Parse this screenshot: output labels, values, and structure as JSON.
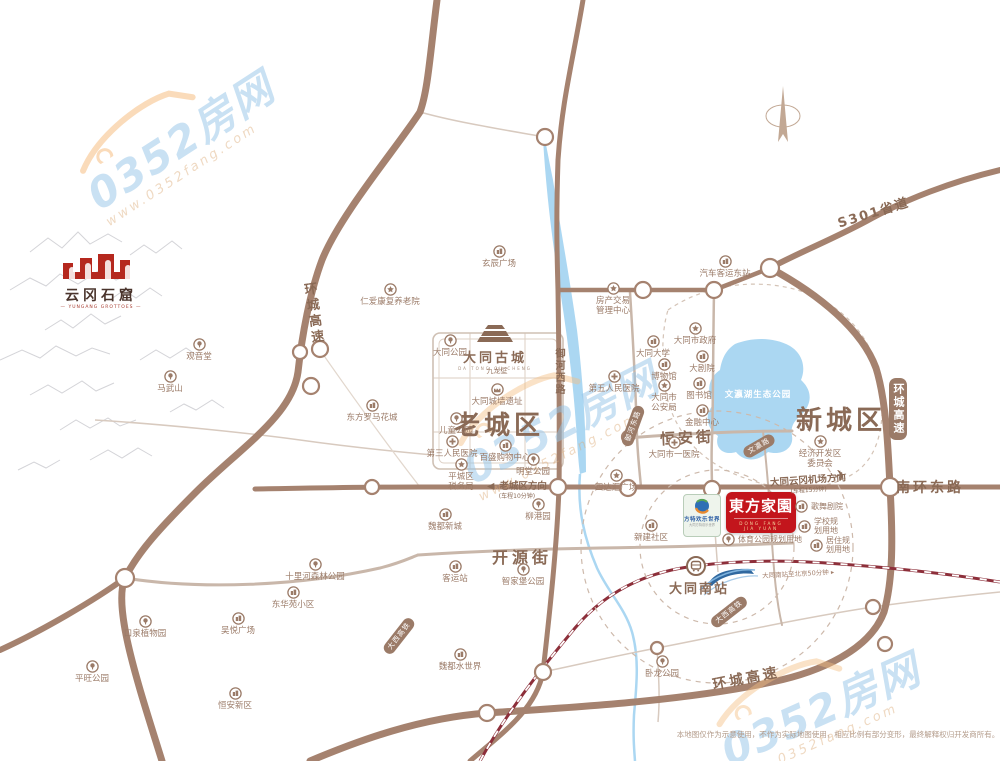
{
  "watermark": {
    "brand": "0352房网",
    "url": "www.0352fang.com"
  },
  "districts": {
    "old": "老城区",
    "new": "新城区"
  },
  "roads": {
    "ring_left": "环城高速",
    "ring_right": "环城高速",
    "ring_bottom": "环城高速",
    "s301": "S301省道",
    "nanhuan": "南环东路",
    "hengan": "恒安街",
    "kaiyuan": "开源街",
    "yuhe_west": "御河西路"
  },
  "badges": {
    "yuhe_east": "御河东路",
    "wenying_rd": "文瀛路",
    "daxi_a": "大西高铁",
    "daxi_b": "大西高铁"
  },
  "lake_label": "文瀛湖生态公园",
  "logos": {
    "yungang": {
      "title": "云冈石窟",
      "subtitle": "— YUNGANG GROTTOES —"
    },
    "gucheng": {
      "title": "大同古城",
      "subtitle": "DA TONG GU CHENG"
    },
    "fangte": {
      "title": "方特欢乐世界",
      "subtitle": "大同方特欢乐世界"
    },
    "dongfang": {
      "title": "東方家園",
      "subtitle": "DONG FANG JIA YUAN"
    }
  },
  "station": {
    "name": "大同南站",
    "note": "大同南站至北京50分钟",
    "note_arrow": "▸"
  },
  "directions": {
    "oldtown": {
      "arrow": "◀",
      "main": "老城区方向",
      "sub": "(车程10分钟)"
    },
    "airport": {
      "main": "大同云冈机场方向",
      "sub": "(车程15分钟)",
      "plane": "✈"
    }
  },
  "pois": {
    "guanyintang": "观音堂",
    "mawushan": "马武山",
    "renai": "仁爱康复养老院",
    "xuanchen": "玄辰广场",
    "datong_park": "大同公园",
    "ertong_park": "儿童公园",
    "roma": "东方罗马花城",
    "disan_hosp": "第三人民医院",
    "shuiwu": "平城区\n税务局",
    "baisheng": "百盛购物中心",
    "mingtang": "明堂公园",
    "liugang": "柳港园",
    "weidu_xincheng": "魏都新城",
    "keyun": "客运站",
    "zhijiabao": "智家堡公园",
    "shilihe": "十里河森林公园",
    "donghuayuan": "东华苑小区",
    "kouquan": "口泉植物园",
    "wuyue": "吴悦广场",
    "pingwang": "平旺公园",
    "hengan_xinqu": "恒安新区",
    "weidu_water": "魏都水世界",
    "wolong": "卧龙公园",
    "fangchan": "房产交易\n管理中心",
    "diwu_hosp": "第五人民医院",
    "qiche_dong": "汽车客运东站",
    "shizhengfu": "大同市政府",
    "daxue": "大同大学",
    "bowuguan": "博物馆",
    "dajuyuan": "大剧院",
    "tushuguan": "图书馆",
    "gongan": "大同市\n公安局",
    "jinrong": "金融中心",
    "yi_hosp": "大同市一医院",
    "jingkai": "经济开发区\n委员会",
    "sidahui": "四达汇广场",
    "xinjian": "新建社区",
    "chengqiang": "大同城墙遗址",
    "jiulongbi": "九龙壁",
    "tiyu": "体育公园规划用地",
    "gewu": "歌舞剧院",
    "xuexiao": "学校规\n划用地",
    "juzhu": "居住规\n划用地"
  },
  "disclaimer": "本地图仅作为示意使用，不作为实际地图使用，相应比例有部分变形，最终解释权归开发商所有。"
}
